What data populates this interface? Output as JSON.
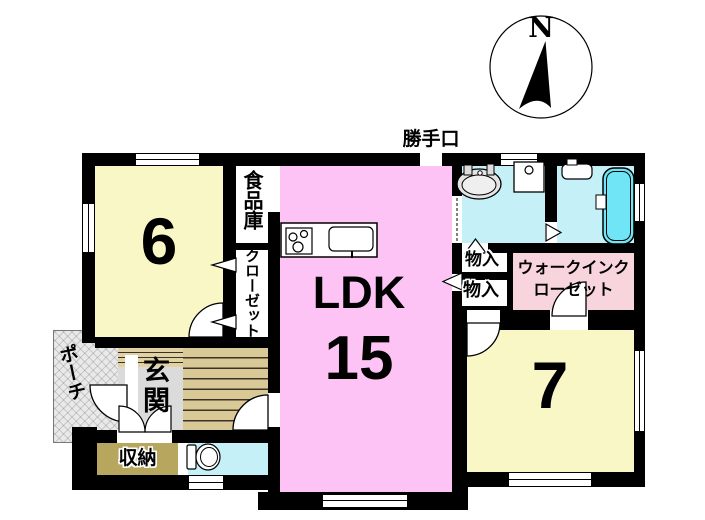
{
  "title": "間取り図",
  "compass": {
    "north_label": "N"
  },
  "labels": {
    "back_door": "勝手口",
    "room6_size": "6",
    "pantry": "食品庫",
    "closet": "クローゼット",
    "ldk": "LDK",
    "ldk_size": "15",
    "storage_upper": "物入",
    "storage_lower": "物入",
    "wic_line1": "ウォークインク",
    "wic_line2": "ローゼット",
    "room7_size": "7",
    "porch": "ポーチ",
    "entrance": "玄関",
    "shoe_storage": "収納"
  },
  "rooms": [
    {
      "name": "western-room-6",
      "label": "6",
      "color": "#FAF7C6"
    },
    {
      "name": "pantry",
      "label": "食品庫",
      "color": "#FFFFFF"
    },
    {
      "name": "closet",
      "label": "クローゼット",
      "color": "#FFFFFF"
    },
    {
      "name": "ldk",
      "label": "LDK 15",
      "color": "#FEC3F5"
    },
    {
      "name": "washroom",
      "label": "",
      "color": "#C6F0F8"
    },
    {
      "name": "bathroom",
      "label": "",
      "color": "#C6F0F8"
    },
    {
      "name": "storage-upper",
      "label": "物入",
      "color": "#FFFFFF"
    },
    {
      "name": "storage-lower",
      "label": "物入",
      "color": "#FFFFFF"
    },
    {
      "name": "walk-in-closet",
      "label": "ウォークインクローゼット",
      "color": "#F8D5DC"
    },
    {
      "name": "western-room-7",
      "label": "7",
      "color": "#FAF7C6"
    },
    {
      "name": "entrance",
      "label": "玄関",
      "color": "#DBDBDB"
    },
    {
      "name": "hallway",
      "label": "",
      "color": "#D9C996"
    },
    {
      "name": "porch",
      "label": "ポーチ",
      "color": "#E9E9E9"
    },
    {
      "name": "shoe-storage",
      "label": "収納",
      "color": "#B7A75E"
    },
    {
      "name": "toilet",
      "label": "",
      "color": "#C6F0F8"
    }
  ],
  "colors": {
    "wall": "#000000",
    "room_yellow": "#FAF7C6",
    "ldk_pink": "#FEC3F5",
    "wic_pink": "#F8D5DC",
    "water_cyan": "#C6F0F8",
    "bathtub_cyan": "#6FE5F5",
    "hall_tan": "#D9C996",
    "entrance_gray": "#DBDBDB",
    "shoe_storage_khaki": "#B7A75E"
  }
}
